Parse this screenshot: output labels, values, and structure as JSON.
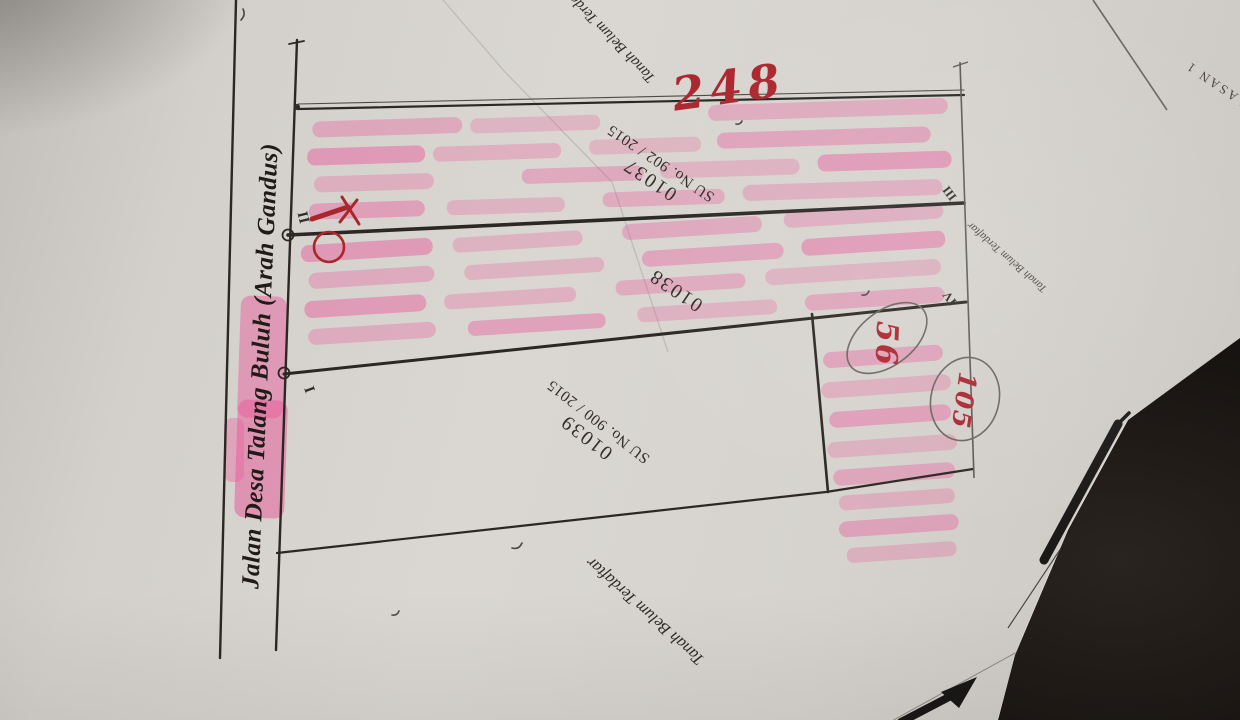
{
  "sketch": {
    "road_label": "Jalan Desa Talang Buluh (Arah Gandus)",
    "total_label": "248",
    "parcels": {
      "p37": {
        "id": "01037",
        "su": "SU No. 902 / 2015"
      },
      "p38": {
        "id": "01038"
      },
      "p39": {
        "id": "01039",
        "su": "SU No. 900 / 2015"
      }
    },
    "unregistered": {
      "top": "Tanah Belum Terdaftar",
      "right": "Tanah Belum Terdaftar",
      "bottom": "Tanah Belum Terdaftar"
    },
    "corners": {
      "i": "I",
      "ii": "II",
      "iii": "III",
      "iv": "IV"
    },
    "areas": {
      "small_parcel": "56",
      "side_parcel": "105"
    },
    "corner_fragment": "LASAN 1"
  },
  "colors": {
    "paper": "#d6d3ce",
    "background": "#16120f",
    "ink": "#2b2724",
    "pencil": "#6b665f",
    "highlighter": "#e85f9d",
    "red_pen": "#ac2730"
  }
}
